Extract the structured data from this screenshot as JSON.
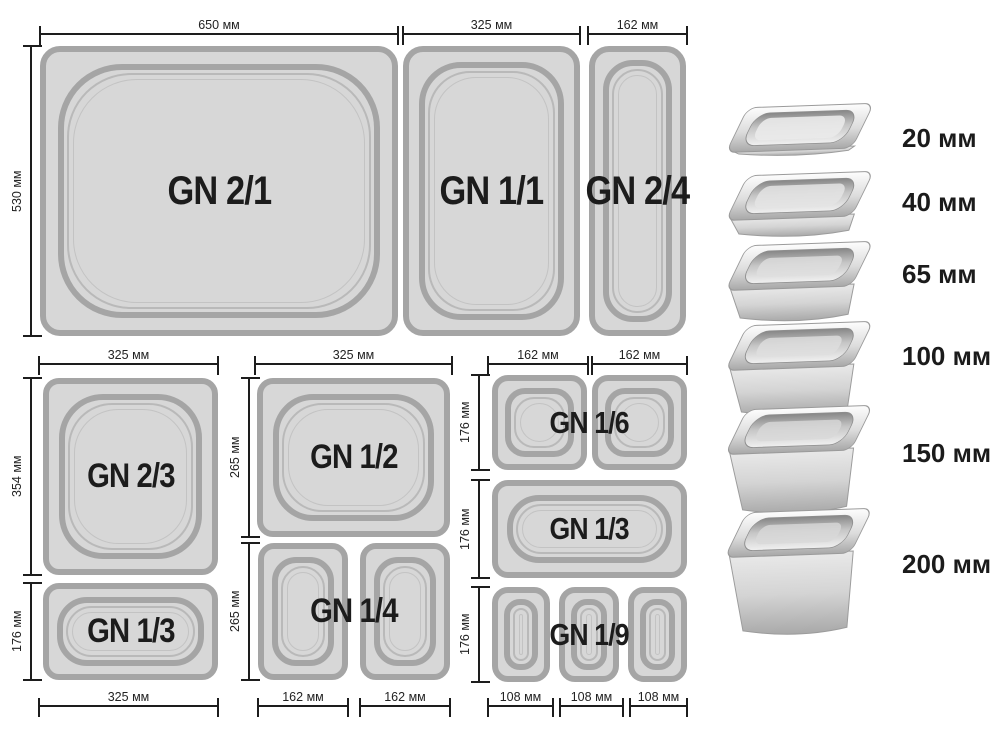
{
  "colors": {
    "pan_fill": "#d7d7d7",
    "pan_border": "#a5a5a5",
    "dimension_line": "#1d1d1d",
    "label_text": "#1c1c1c",
    "steel_light": "#f5f5f5",
    "steel_dark": "#9a9a9a"
  },
  "pans": {
    "gn21": "GN 2/1",
    "gn11": "GN 1/1",
    "gn24": "GN 2/4",
    "gn23": "GN 2/3",
    "gn13a": "GN 1/3",
    "gn12": "GN 1/2",
    "gn14": "GN 1/4",
    "gn16": "GN 1/6",
    "gn13b": "GN 1/3",
    "gn19": "GN 1/9"
  },
  "dims": {
    "w650": "650 мм",
    "h530": "530 мм",
    "w325_top": "325 мм",
    "w162_top": "162 мм",
    "b_top": "325 мм",
    "b_h354": "354 мм",
    "b_h176": "176 мм",
    "b_bottom": "325 мм",
    "c_top": "325 мм",
    "c_h265a": "265 мм",
    "c_h265b": "265 мм",
    "c_w162a": "162 мм",
    "c_w162b": "162 мм",
    "d_w162a": "162 мм",
    "d_w162b": "162 мм",
    "d_h176a": "176 мм",
    "d_h176b": "176 мм",
    "d_h176c": "176 мм",
    "d_w108a": "108 мм",
    "d_w108b": "108 мм",
    "d_w108c": "108 мм"
  },
  "depths": [
    {
      "label": "20 мм"
    },
    {
      "label": "40 мм"
    },
    {
      "label": "65 мм"
    },
    {
      "label": "100 мм"
    },
    {
      "label": "150 мм"
    },
    {
      "label": "200 мм"
    }
  ]
}
